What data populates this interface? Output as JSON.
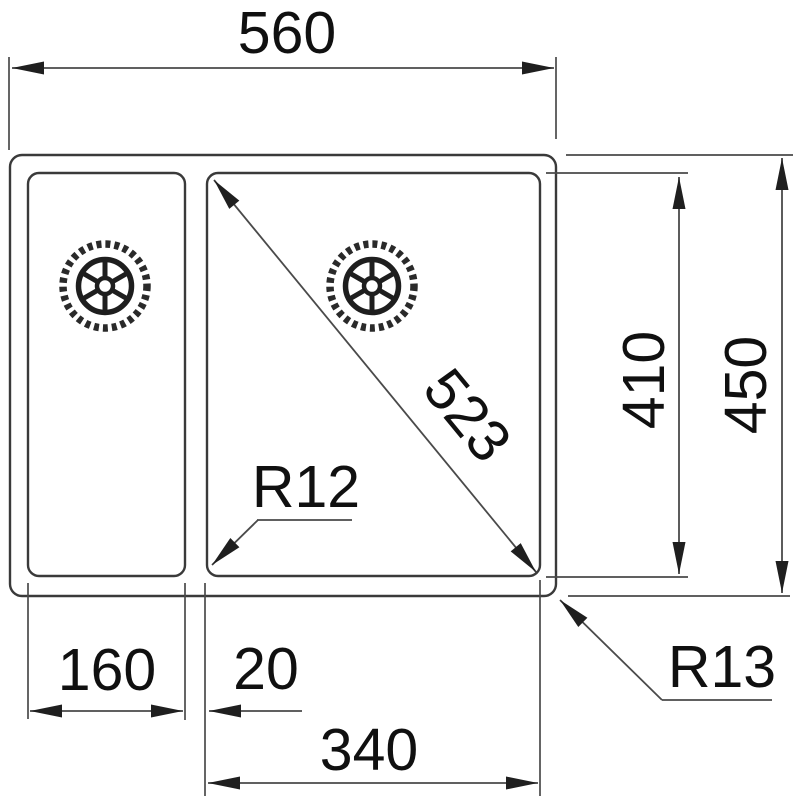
{
  "drawing": {
    "kind": "sink-technical-dimension-drawing",
    "labels": {
      "overall_width": "560",
      "inner_depth": "410",
      "overall_depth": "450",
      "diagonal": "523",
      "left_bowl_width": "160",
      "divider_width": "20",
      "right_bowl_width": "340",
      "inner_corner_radius": "R12",
      "outer_corner_radius": "R13"
    },
    "colors": {
      "line": "#3a3a3a",
      "dimension_line": "#4a4a4a",
      "text": "#101010",
      "background": "#ffffff"
    }
  }
}
